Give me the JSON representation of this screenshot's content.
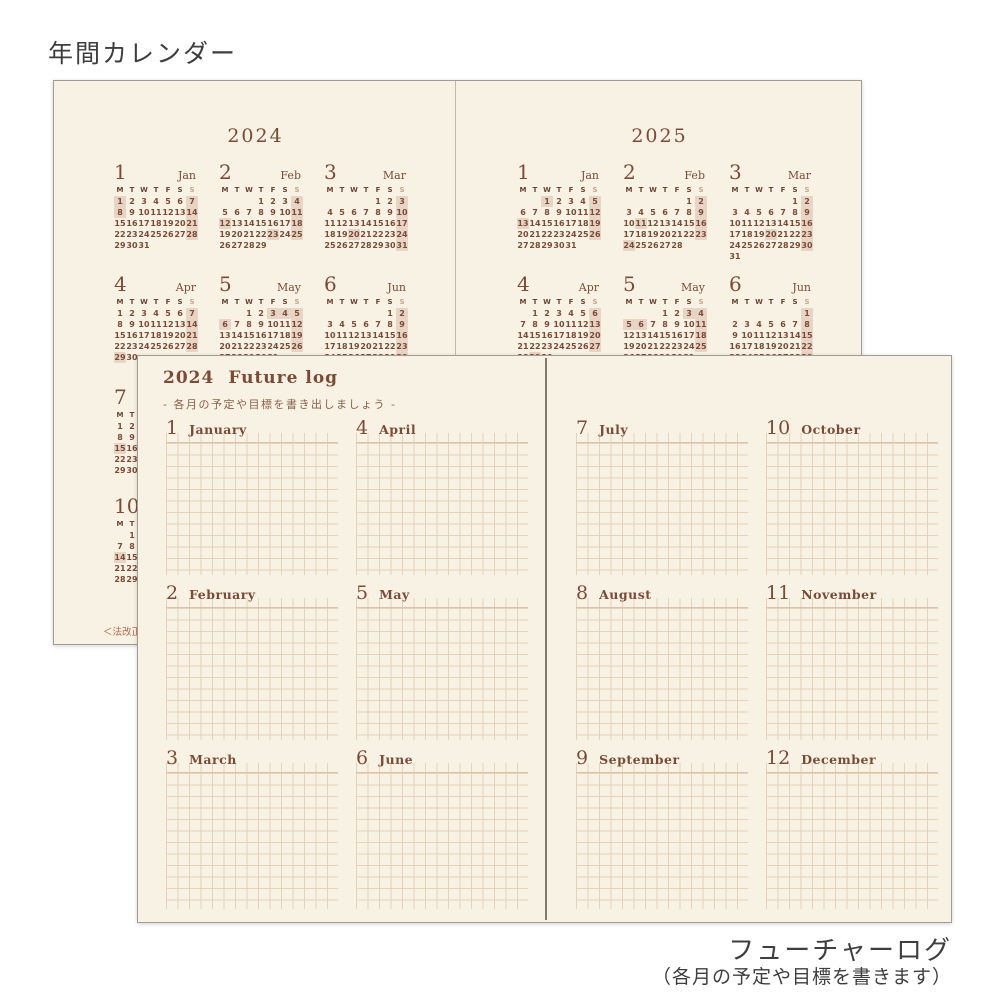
{
  "page_labels": {
    "top_title": "年間カレンダー",
    "bottom_title": "フューチャーログ",
    "bottom_subtitle": "（各月の予定や目標を書きます）",
    "disclaimer": "＜法改正"
  },
  "weekdays": [
    "M",
    "T",
    "W",
    "T",
    "F",
    "S",
    "S"
  ],
  "yearly_calendar": {
    "pages": [
      {
        "year": "2024",
        "months": [
          {
            "num": "1",
            "name": "Jan",
            "first_weekday_mon0": 0,
            "days": 31,
            "highlighted": [
              1,
              7,
              8,
              14,
              21,
              28
            ],
            "col": 0,
            "row": 0
          },
          {
            "num": "2",
            "name": "Feb",
            "first_weekday_mon0": 3,
            "days": 29,
            "highlighted": [
              4,
              11,
              12,
              18,
              23,
              25
            ],
            "col": 1,
            "row": 0
          },
          {
            "num": "3",
            "name": "Mar",
            "first_weekday_mon0": 4,
            "days": 31,
            "highlighted": [
              3,
              10,
              17,
              20,
              24,
              31
            ],
            "col": 2,
            "row": 0
          },
          {
            "num": "4",
            "name": "Apr",
            "first_weekday_mon0": 0,
            "days": 30,
            "highlighted": [
              7,
              14,
              21,
              28,
              29
            ],
            "col": 0,
            "row": 1
          },
          {
            "num": "5",
            "name": "May",
            "first_weekday_mon0": 2,
            "days": 31,
            "highlighted": [
              3,
              4,
              5,
              6,
              12,
              19,
              26
            ],
            "col": 1,
            "row": 1
          },
          {
            "num": "6",
            "name": "Jun",
            "first_weekday_mon0": 5,
            "days": 30,
            "highlighted": [
              2,
              9,
              16,
              23,
              30
            ],
            "col": 2,
            "row": 1
          },
          {
            "num": "7",
            "name": "Jul",
            "first_weekday_mon0": 0,
            "days": 31,
            "highlighted": [
              15
            ],
            "col": 0,
            "row": 2
          },
          {
            "num": "10",
            "name": "Oct",
            "first_weekday_mon0": 1,
            "days": 31,
            "highlighted": [
              14
            ],
            "col": 0,
            "row": 3
          }
        ]
      },
      {
        "year": "2025",
        "months": [
          {
            "num": "1",
            "name": "Jan",
            "first_weekday_mon0": 2,
            "days": 31,
            "highlighted": [
              1,
              5,
              12,
              13,
              19,
              26
            ],
            "col": 0,
            "row": 0
          },
          {
            "num": "2",
            "name": "Feb",
            "first_weekday_mon0": 5,
            "days": 28,
            "highlighted": [
              2,
              9,
              11,
              16,
              23,
              24
            ],
            "col": 1,
            "row": 0
          },
          {
            "num": "3",
            "name": "Mar",
            "first_weekday_mon0": 5,
            "days": 31,
            "highlighted": [
              2,
              9,
              16,
              20,
              23,
              30
            ],
            "col": 2,
            "row": 0
          },
          {
            "num": "4",
            "name": "Apr",
            "first_weekday_mon0": 1,
            "days": 30,
            "highlighted": [
              6,
              13,
              20,
              27,
              29
            ],
            "col": 0,
            "row": 1
          },
          {
            "num": "5",
            "name": "May",
            "first_weekday_mon0": 3,
            "days": 31,
            "highlighted": [
              3,
              4,
              5,
              6,
              11,
              18,
              25
            ],
            "col": 1,
            "row": 1
          },
          {
            "num": "6",
            "name": "Jun",
            "first_weekday_mon0": 6,
            "days": 30,
            "highlighted": [
              1,
              8,
              15,
              22,
              29
            ],
            "col": 2,
            "row": 1
          }
        ]
      }
    ]
  },
  "future_log": {
    "title_year": "2024",
    "title_text": "Future log",
    "subtitle": "- 各月の予定や目標を書き出しましょう -",
    "months": [
      {
        "num": "1",
        "name": "January",
        "page": 0,
        "col": 0,
        "row": 0
      },
      {
        "num": "2",
        "name": "February",
        "page": 0,
        "col": 0,
        "row": 1
      },
      {
        "num": "3",
        "name": "March",
        "page": 0,
        "col": 0,
        "row": 2
      },
      {
        "num": "4",
        "name": "April",
        "page": 0,
        "col": 1,
        "row": 0
      },
      {
        "num": "5",
        "name": "May",
        "page": 0,
        "col": 1,
        "row": 1
      },
      {
        "num": "6",
        "name": "June",
        "page": 0,
        "col": 1,
        "row": 2
      },
      {
        "num": "7",
        "name": "July",
        "page": 1,
        "col": 0,
        "row": 0
      },
      {
        "num": "8",
        "name": "August",
        "page": 1,
        "col": 0,
        "row": 1
      },
      {
        "num": "9",
        "name": "September",
        "page": 1,
        "col": 0,
        "row": 2
      },
      {
        "num": "10",
        "name": "October",
        "page": 1,
        "col": 1,
        "row": 0
      },
      {
        "num": "11",
        "name": "November",
        "page": 1,
        "col": 1,
        "row": 1
      },
      {
        "num": "12",
        "name": "December",
        "page": 1,
        "col": 1,
        "row": 2
      }
    ]
  },
  "colors": {
    "cream": "#f7f2e4",
    "brown": "#7c4b38",
    "brown_soft": "#8a614c",
    "sunday": "#c8a58f",
    "highlight": "#e8d4c4",
    "grid": "#e4d3ba",
    "underline": "#dcc3ab",
    "border": "#a19d94",
    "caption": "#3e3e3e",
    "disclaimer": "#b06a50",
    "divider": "#55504a"
  }
}
